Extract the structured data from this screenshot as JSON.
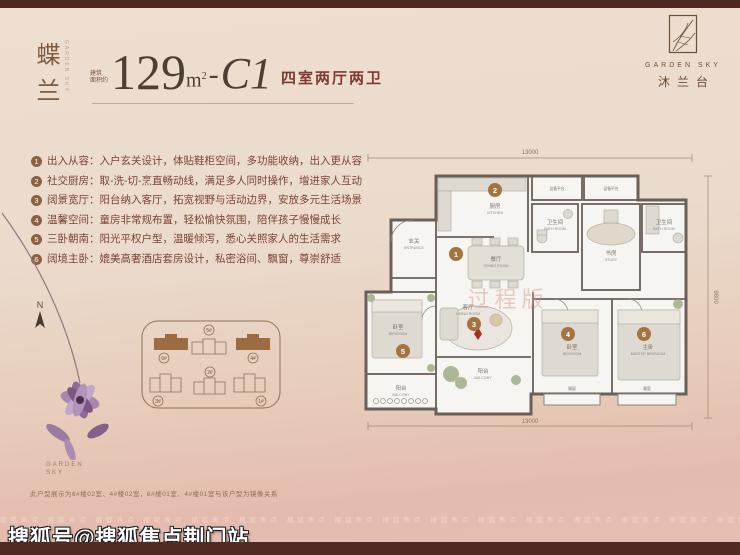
{
  "plan_name": {
    "cn": "蝶兰",
    "en": "GARDEN SKY"
  },
  "headline": {
    "area_prefix": "建筑\n面积约",
    "area": "129",
    "unit_base": "m",
    "unit_sup": "2",
    "dash": "-",
    "type_code": "C1",
    "layout": "四室两厅两卫"
  },
  "logo": {
    "en": "GARDEN SKY",
    "cn": "沐兰台"
  },
  "features": [
    {
      "num": "1",
      "text": "出入从容：入户玄关设计，体贴鞋柜空间，多功能收纳，出入更从容"
    },
    {
      "num": "2",
      "text": "社交厨房：取-洗-切-烹直畅动线，满足多人同时操作，增进家人互动"
    },
    {
      "num": "3",
      "text": "阔景宽厅：阳台纳入客厅，拓宽视野与活动边界，安放多元生活场景"
    },
    {
      "num": "4",
      "text": "温馨空间：童房非常规布置，轻松愉快氛围，陪伴孩子慢慢成长"
    },
    {
      "num": "5",
      "text": "三卧朝南：阳光平权户型，温暖倾泻，悉心关照家人的生活需求"
    },
    {
      "num": "6",
      "text": "阔境主卧：媲美高奢酒店套房设计，私密浴间、飘窗，尊崇舒适"
    }
  ],
  "floorplan": {
    "dims": {
      "top": "13000",
      "bottom": "13000",
      "right": "9800"
    },
    "watermark": "过程版",
    "markers": [
      "1",
      "2",
      "3",
      "4",
      "5",
      "6"
    ],
    "rooms": {
      "entrance": {
        "zh": "玄关",
        "en": "ENTRANCE"
      },
      "kitchen": {
        "zh": "厨房",
        "en": "KITCHEN"
      },
      "dining": {
        "zh": "餐厅",
        "en": "DINING ROOM"
      },
      "living": {
        "zh": "客厅",
        "en": "LIVING ROOM"
      },
      "study": {
        "zh": "书房",
        "en": "STUDY"
      },
      "bath1": {
        "zh": "卫生间",
        "en": "BATH ROOM"
      },
      "bath2": {
        "zh": "卫生间",
        "en": "BATH ROOM"
      },
      "platform1": {
        "zh": "设备平台"
      },
      "platform2": {
        "zh": "设备平台"
      },
      "bedroom5": {
        "zh": "卧室",
        "en": "BEDROOM"
      },
      "bedroom4": {
        "zh": "卧室",
        "en": "BEDROOM"
      },
      "master": {
        "zh": "主卧",
        "en": "MASTER BEDROOM"
      },
      "balcony1": {
        "zh": "阳台",
        "en": "BALCONY"
      },
      "balcony2": {
        "zh": "阳台",
        "en": "BALCONY"
      },
      "bay1": {
        "zh": "飘窗"
      },
      "bay2": {
        "zh": "飘窗"
      }
    }
  },
  "siteplan": {
    "compass": "N",
    "buildings": [
      {
        "id": "6#",
        "highlighted": true
      },
      {
        "id": "5#",
        "highlighted": false
      },
      {
        "id": "4#",
        "highlighted": true
      },
      {
        "id": "3#",
        "highlighted": false
      },
      {
        "id": "2#",
        "highlighted": false
      },
      {
        "id": "1#",
        "highlighted": false
      }
    ]
  },
  "footer": {
    "brand": "GARDEN\nSKY",
    "disclaimer": "此户型展示为6#楼02室、4#楼02室，6#楼01室、4#楼01室与该户型为镜像关系"
  },
  "watermarks": {
    "faint_row": "搜狐焦点 搜狐焦点 搜狐焦点 搜狐焦点 搜狐焦点 搜狐焦点 搜狐焦点 搜狐焦点 搜狐焦点 搜狐焦点 搜狐焦点 搜狐焦点 搜狐焦点 搜狐焦点 搜狐焦点 搜狐焦点",
    "sohu": "搜狐号@搜狐焦点荆门站"
  }
}
